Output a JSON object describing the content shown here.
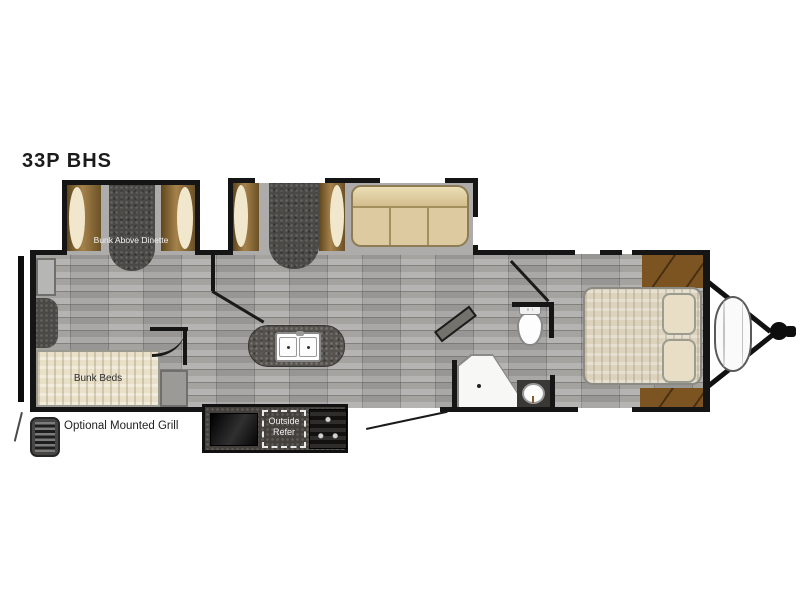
{
  "title": "33P BHS",
  "floorplan": {
    "labels": {
      "bunk_above_dinette": "Bunk Above Dinette",
      "bunk_beds": "Bunk Beds",
      "optional_mounted_grill": "Optional Mounted Grill",
      "outside_refer": "Outside Refer"
    },
    "features": [
      "bunk-above-dinette",
      "dinette-booth",
      "sofa",
      "bunk-beds",
      "wardrobe-cabinets",
      "kitchen-island-double-sink",
      "entry-door",
      "toilet",
      "neo-angle-shower",
      "bathroom-sink-vanity",
      "queen-bed-with-pillows",
      "front-wardrobes",
      "outside-refrigerator",
      "outdoor-grill",
      "optional-mounted-grill",
      "rear-bumper",
      "propane-tank",
      "a-frame-hitch"
    ],
    "colors": {
      "wall": "#151515",
      "floor_gray": "#a9a7a4",
      "wood_brown": "#7b5422",
      "bench_brown": "#8a6c3c",
      "cushion_cream": "#f0e7cd",
      "upholstery_tan": "#decaa0",
      "mattress_beige": "#dcd3be",
      "dark_fixture": "#4b4946",
      "granite_counter": "#56534f",
      "fixture_white": "#f7f7f6"
    }
  }
}
